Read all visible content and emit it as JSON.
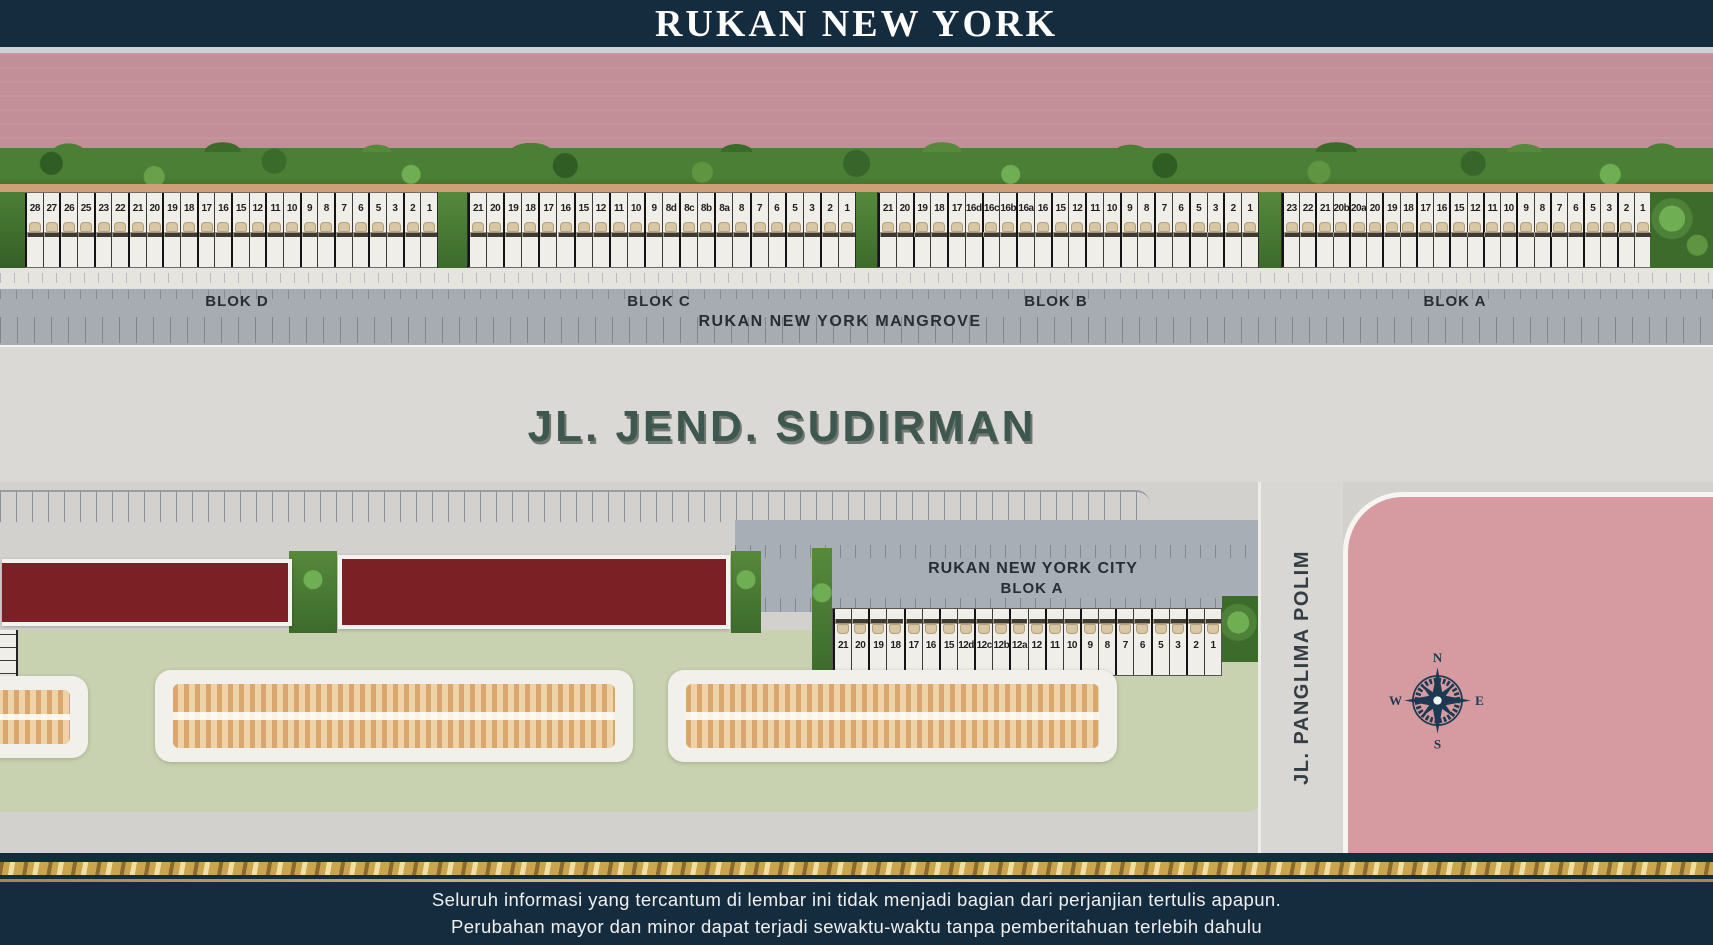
{
  "header": {
    "title": "RUKAN NEW YORK"
  },
  "mangrove_row": {
    "road_label": "RUKAN NEW YORK MANGROVE",
    "blocks": [
      {
        "label": "BLOK D",
        "units": [
          "28",
          "27",
          "26",
          "25",
          "23",
          "22",
          "21",
          "20",
          "19",
          "18",
          "17",
          "16",
          "15",
          "12",
          "11",
          "10",
          "9",
          "8",
          "7",
          "6",
          "5",
          "3",
          "2",
          "1"
        ]
      },
      {
        "label": "BLOK C",
        "units": [
          "21",
          "20",
          "19",
          "18",
          "17",
          "16",
          "15",
          "12",
          "11",
          "10",
          "9",
          "8d",
          "8c",
          "8b",
          "8a",
          "8",
          "7",
          "6",
          "5",
          "3",
          "2",
          "1"
        ]
      },
      {
        "label": "BLOK B",
        "units": [
          "21",
          "20",
          "19",
          "18",
          "17",
          "16d",
          "16c",
          "16b",
          "16a",
          "16",
          "15",
          "12",
          "11",
          "10",
          "9",
          "8",
          "7",
          "6",
          "5",
          "3",
          "2",
          "1"
        ]
      },
      {
        "label": "BLOK A",
        "units": [
          "23",
          "22",
          "21",
          "20b",
          "20a",
          "20",
          "19",
          "18",
          "17",
          "16",
          "15",
          "12",
          "11",
          "10",
          "9",
          "8",
          "7",
          "6",
          "5",
          "3",
          "2",
          "1"
        ]
      }
    ]
  },
  "roads": {
    "main": "JL. JEND. SUDIRMAN",
    "side": "JL. PANGLIMA POLIM"
  },
  "city": {
    "title": "RUKAN NEW YORK CITY",
    "block_label": "BLOK A",
    "units": [
      "21",
      "20",
      "19",
      "18",
      "17",
      "16",
      "15",
      "12d",
      "12c",
      "12b",
      "12a",
      "12",
      "11",
      "10",
      "9",
      "8",
      "7",
      "6",
      "5",
      "3",
      "2",
      "1"
    ]
  },
  "compass": {
    "north": "N",
    "east": "E",
    "south": "S",
    "west": "W"
  },
  "footer": {
    "line1": "Seluruh informasi yang tercantum di lembar ini tidak menjadi bagian dari perjanjian tertulis apapun.",
    "line2": "Perubahan mayor dan minor dapat terjadi sewaktu-waktu tanpa pemberitahuan terlebih dahulu"
  },
  "icons": {
    "unit_marker": "unit-entrance-icon",
    "compass": "compass-rose-icon"
  },
  "colors": {
    "navy": "#152c3e",
    "water_pink": "#c28e98",
    "vegetation_green": "#4e8238",
    "brick_red": "#7b2025",
    "lawn_green": "#c8d2b0",
    "zone_pink": "#d69ba1",
    "gold": "#c9a54f",
    "road_gray": "#a7acb2",
    "asphalt_light": "#dbd9d5",
    "label_dark": "#272e33",
    "sudirman_green": "#3f584f"
  }
}
